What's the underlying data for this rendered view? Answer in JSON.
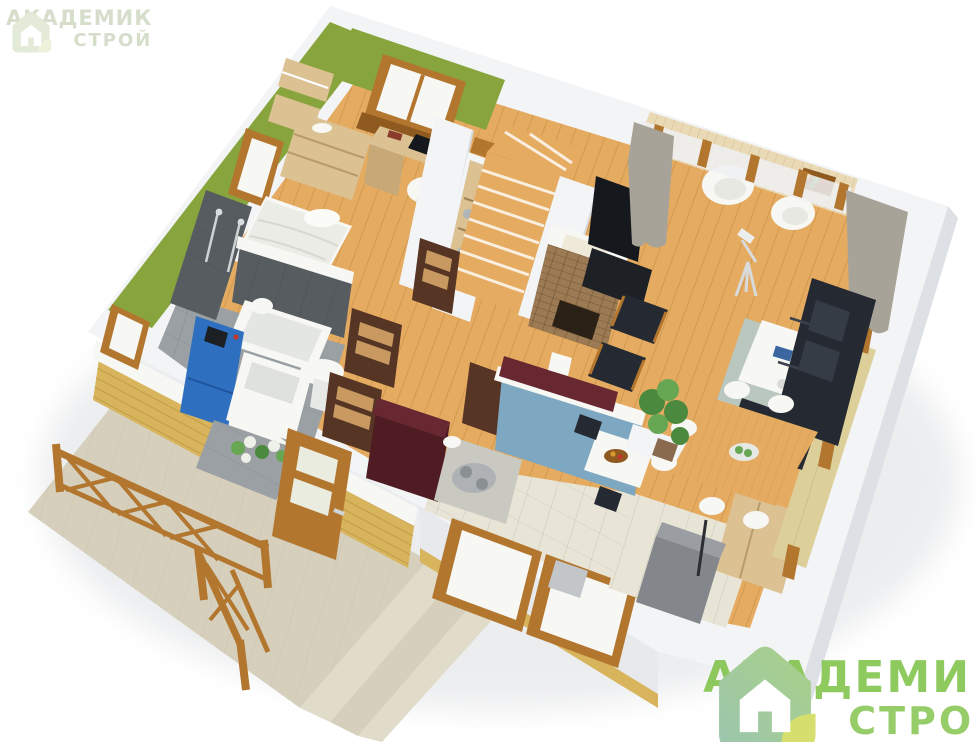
{
  "scene": {
    "type": "3d-isometric-floorplan",
    "description": "single-storey house cutaway render",
    "rooms": [
      {
        "name": "bedroom",
        "items": [
          "bed",
          "dresser",
          "wall-shelves",
          "desk",
          "laptop",
          "office-chair",
          "window",
          "green-walls"
        ]
      },
      {
        "name": "bathroom",
        "items": [
          "shower",
          "bathtub",
          "sink",
          "toilet",
          "boiler",
          "washing-machine",
          "dark-tile-walls"
        ]
      },
      {
        "name": "hallway",
        "items": [
          "wood-floor",
          "open-doors"
        ]
      },
      {
        "name": "stairs",
        "items": [
          "winder-staircase",
          "shelf-unit",
          "fireplace",
          "tv"
        ]
      },
      {
        "name": "kitchen",
        "items": [
          "burgundy-cabinets",
          "island-stove",
          "blue-wall",
          "breakfast-table",
          "windows",
          "sink"
        ]
      },
      {
        "name": "living-room",
        "items": [
          "corner-sofa",
          "coffee-table",
          "rug",
          "dining-table",
          "six-chairs",
          "armchairs",
          "plant",
          "telescope",
          "curtains"
        ]
      },
      {
        "name": "balcony",
        "items": [
          "two-white-armchairs",
          "flower-box",
          "glass-doors"
        ]
      },
      {
        "name": "entry",
        "items": [
          "wardrobe",
          "storage-box",
          "tile-floor"
        ]
      },
      {
        "name": "terrace",
        "items": [
          "concrete-porch",
          "steps",
          "wood-railing",
          "entry-door",
          "yellow-brick-wall"
        ]
      }
    ]
  },
  "logo_small": {
    "line1": "АКАДЕМИК",
    "line2": "СТРОЙ"
  },
  "logo_big": {
    "line1": "АКАДЕМИК",
    "line2": "СТРОЙ"
  },
  "palette": {
    "bg": "#ffffff",
    "shell": "#f3f4f6",
    "shell_shade": "#e7e9ed",
    "shell_edge": "#dde0e5",
    "wood1": "#e5ab61",
    "balcony_wood": "#ead9b5",
    "green_wall": "#88a43c",
    "green_dark": "#76922f",
    "wood_frame": "#b2762f",
    "frame_dark": "#8f5a20",
    "dark_tile": "#565c60",
    "dark_tile2": "#474d51",
    "gray_floor": "#9aa0a4",
    "burgundy": "#4e1c22",
    "burgundy2": "#682831",
    "blue_wall": "#7ea8c1",
    "sofa": "#252a32",
    "sofa2": "#353c46",
    "rug": "#bac7be",
    "curtain": "#a8a398",
    "concrete": "#d5cfbc",
    "concrete2": "#e1dbca",
    "brick": "#d8b55c",
    "brick2": "#c09840",
    "stone": "#9c7b54",
    "boiler": "#2e70bf",
    "white_obj": "#f7f7f4",
    "tv": "#15181c",
    "plant": "#4b8a3e",
    "plant2": "#67a653",
    "tile_beige": "#e9e5d6",
    "mat": "#dccf9a",
    "door_dark": "#563524",
    "door_slat": "#c89a62",
    "desk_wood": "#dcc193",
    "gray_box": "#83878b",
    "logo_green": "#7cc144",
    "logo_pale": "#d4decb"
  }
}
